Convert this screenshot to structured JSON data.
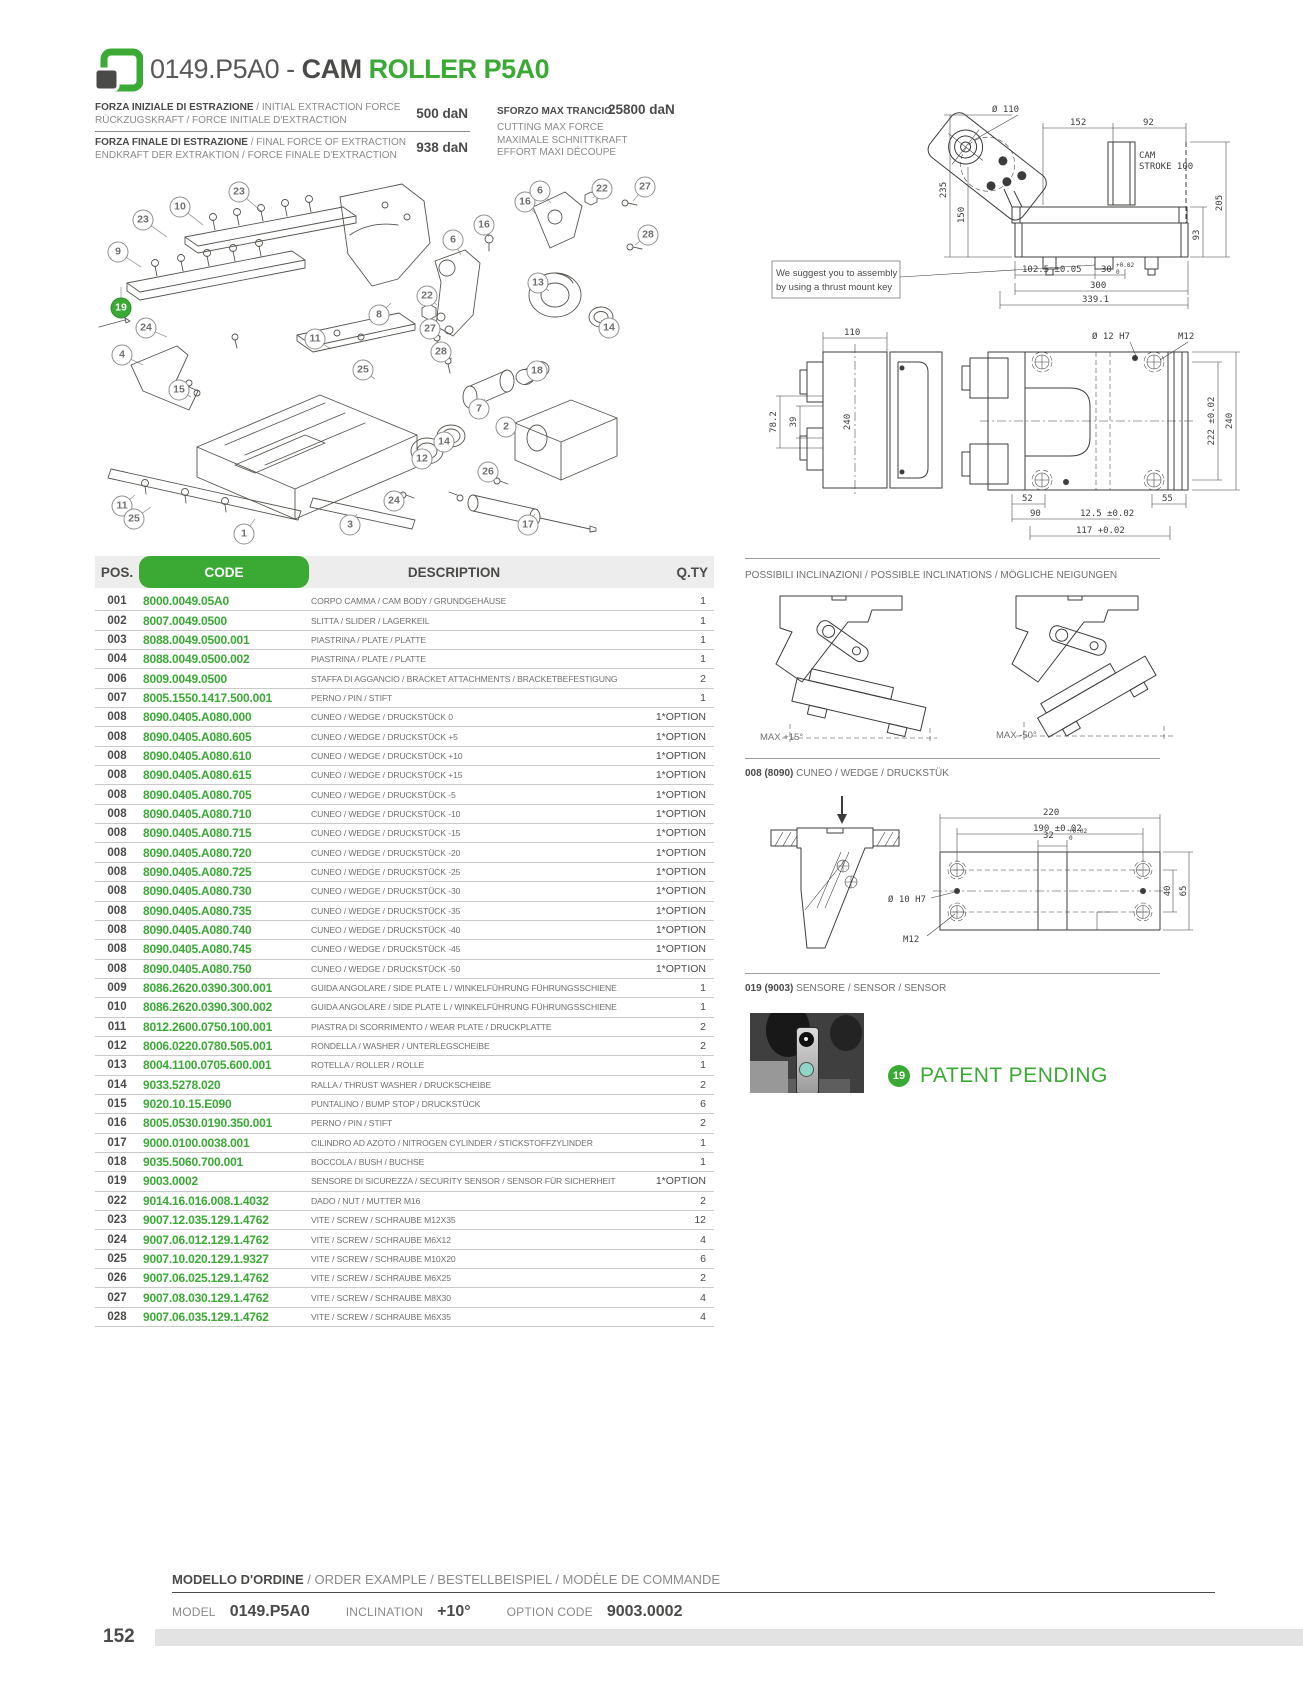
{
  "colors": {
    "green": "#3aaa35",
    "dark": "#4a4a49",
    "desc_gray": "#706f6f",
    "line_gray": "#c9c9c9",
    "header_bg": "#ededed",
    "teal": "#8fd6c6"
  },
  "header": {
    "code_text": "0149.P5A0 - ",
    "title_cam": "CAM ",
    "title_roller": "ROLLER P5A0",
    "logo_icon": "green-frame-logo"
  },
  "specs": {
    "initial": {
      "bold": "FORZA INIZIALE DI ESTRAZIONE",
      "rest": " / INITIAL EXTRACTION FORCE",
      "line2": "RÜCKZUGSKRAFT / FORCE INITIALE D'EXTRACTION",
      "value": "500 daN"
    },
    "final": {
      "bold": "FORZA FINALE DI ESTRAZIONE",
      "rest": " / FINAL FORCE OF EXTRACTION",
      "line2": "ENDKRAFT DER EXTRAKTION / FORCE FINALE D'EXTRACTION",
      "value": "938 daN"
    },
    "cutting": {
      "title": "SFORZO MAX TRANCIO",
      "value": "25800 daN",
      "l2": "CUTTING MAX FORCE",
      "l3": "MAXIMALE SCHNITTKRAFT",
      "l4": "EFFORT MAXI DÉCOUPE"
    }
  },
  "drawing1": {
    "note1": "We suggest you to assembly",
    "note2": "by using a thrust mount key",
    "dims": {
      "dia110": "Ø 110",
      "w152": "152",
      "w92": "92",
      "cam_l1": "CAM",
      "cam_l2": "STROKE 100",
      "h235": "235",
      "h150": "150",
      "h205": "205",
      "h93": "93",
      "w1025": "102.5 ±0.05",
      "w30": "30",
      "tol_up": "+0.02",
      "tol_dn": "0",
      "w300": "300",
      "w3391": "339.1"
    }
  },
  "drawing2": {
    "dims": {
      "w110": "110",
      "h782": "78.2",
      "h39": "39",
      "h240": "240",
      "dia12": "Ø 12 H7",
      "m12": "M12",
      "w52": "52",
      "w55": "55",
      "w90": "90",
      "w125": "12.5 ±0.02",
      "w117": "117 +0.02",
      "h222": "222 ±0.02",
      "h240r": "240"
    }
  },
  "table": {
    "headers": {
      "pos": "POS.",
      "code": "CODE",
      "desc": "DESCRIPTION",
      "qty": "Q.TY"
    },
    "rows": [
      [
        "001",
        "8000.0049.05A0",
        "CORPO CAMMA / CAM BODY / GRUNDGEHÄUSE",
        "1"
      ],
      [
        "002",
        "8007.0049.0500",
        "SLITTA / SLIDER / LAGERKEIL",
        "1"
      ],
      [
        "003",
        "8088.0049.0500.001",
        "PIASTRINA / PLATE / PLATTE",
        "1"
      ],
      [
        "004",
        "8088.0049.0500.002",
        "PIASTRINA / PLATE / PLATTE",
        "1"
      ],
      [
        "006",
        "8009.0049.0500",
        "STAFFA DI AGGANCIO / BRACKET ATTACHMENTS / BRACKETBEFESTIGUNG",
        "2"
      ],
      [
        "007",
        "8005.1550.1417.500.001",
        "PERNO / PIN / STIFT",
        "1"
      ],
      [
        "008",
        "8090.0405.A080.000",
        "CUNEO / WEDGE / DRUCKSTÜCK 0",
        "1*OPTION"
      ],
      [
        "008",
        "8090.0405.A080.605",
        "CUNEO / WEDGE / DRUCKSTÜCK +5",
        "1*OPTION"
      ],
      [
        "008",
        "8090.0405.A080.610",
        "CUNEO / WEDGE / DRUCKSTÜCK +10",
        "1*OPTION"
      ],
      [
        "008",
        "8090.0405.A080.615",
        "CUNEO / WEDGE / DRUCKSTÜCK +15",
        "1*OPTION"
      ],
      [
        "008",
        "8090.0405.A080.705",
        "CUNEO / WEDGE / DRUCKSTÜCK -5",
        "1*OPTION"
      ],
      [
        "008",
        "8090.0405.A080.710",
        "CUNEO / WEDGE / DRUCKSTÜCK -10",
        "1*OPTION"
      ],
      [
        "008",
        "8090.0405.A080.715",
        "CUNEO / WEDGE / DRUCKSTÜCK -15",
        "1*OPTION"
      ],
      [
        "008",
        "8090.0405.A080.720",
        "CUNEO / WEDGE / DRUCKSTÜCK -20",
        "1*OPTION"
      ],
      [
        "008",
        "8090.0405.A080.725",
        "CUNEO / WEDGE / DRUCKSTÜCK -25",
        "1*OPTION"
      ],
      [
        "008",
        "8090.0405.A080.730",
        "CUNEO / WEDGE / DRUCKSTÜCK -30",
        "1*OPTION"
      ],
      [
        "008",
        "8090.0405.A080.735",
        "CUNEO / WEDGE / DRUCKSTÜCK -35",
        "1*OPTION"
      ],
      [
        "008",
        "8090.0405.A080.740",
        "CUNEO / WEDGE / DRUCKSTÜCK -40",
        "1*OPTION"
      ],
      [
        "008",
        "8090.0405.A080.745",
        "CUNEO / WEDGE / DRUCKSTÜCK -45",
        "1*OPTION"
      ],
      [
        "008",
        "8090.0405.A080.750",
        "CUNEO / WEDGE / DRUCKSTÜCK -50",
        "1*OPTION"
      ],
      [
        "009",
        "8086.2620.0390.300.001",
        "GUIDA ANGOLARE / SIDE PLATE L / WINKELFÜHRUNG FÜHRUNGSSCHIENE",
        "1"
      ],
      [
        "010",
        "8086.2620.0390.300.002",
        "GUIDA ANGOLARE / SIDE PLATE L / WINKELFÜHRUNG FÜHRUNGSSCHIENE",
        "1"
      ],
      [
        "011",
        "8012.2600.0750.100.001",
        "PIASTRA DI SCORRIMENTO / WEAR PLATE / DRUCKPLATTE",
        "2"
      ],
      [
        "012",
        "8006.0220.0780.505.001",
        "RONDELLA / WASHER / UNTERLEGSCHEIBE",
        "2"
      ],
      [
        "013",
        "8004.1100.0705.600.001",
        "ROTELLA / ROLLER / ROLLE",
        "1"
      ],
      [
        "014",
        "9033.5278.020",
        "RALLA / THRUST WASHER / DRUCKSCHEIBE",
        "2"
      ],
      [
        "015",
        "9020.10.15.E090",
        "PUNTALINO / BUMP STOP / DRUCKSTÜCK",
        "6"
      ],
      [
        "016",
        "8005.0530.0190.350.001",
        "PERNO / PIN / STIFT",
        "2"
      ],
      [
        "017",
        "9000.0100.0038.001",
        "CILINDRO AD AZOTO / NITROGEN CYLINDER / STICKSTOFFZYLINDER",
        "1"
      ],
      [
        "018",
        "9035.5060.700.001",
        "BOCCOLA / BUSH / BUCHSE",
        "1"
      ],
      [
        "019",
        "9003.0002",
        "SENSORE DI SICUREZZA / SECURITY SENSOR / SENSOR FÜR SICHERHEIT",
        "1*OPTION"
      ],
      [
        "022",
        "9014.16.016.008.1.4032",
        "DADO / NUT / MUTTER M16",
        "2"
      ],
      [
        "023",
        "9007.12.035.129.1.4762",
        "VITE / SCREW / SCHRAUBE M12X35",
        "12"
      ],
      [
        "024",
        "9007.06.012.129.1.4762",
        "VITE / SCREW / SCHRAUBE M6X12",
        "4"
      ],
      [
        "025",
        "9007.10.020.129.1.9327",
        "VITE / SCREW / SCHRAUBE M10X20",
        "6"
      ],
      [
        "026",
        "9007.06.025.129.1.4762",
        "VITE / SCREW / SCHRAUBE M6X25",
        "2"
      ],
      [
        "027",
        "9007.08.030.129.1.4762",
        "VITE / SCREW / SCHRAUBE M8X30",
        "4"
      ],
      [
        "028",
        "9007.06.035.129.1.4762",
        "VITE / SCREW / SCHRAUBE M6X35",
        "4"
      ]
    ]
  },
  "inclinations": {
    "title": "POSSIBILI INCLINAZIONI / POSSIBLE INCLINATIONS / MÖGLICHE NEIGUNGEN",
    "left_label": "MAX +15°",
    "right_label": "MAX -50°"
  },
  "wedge": {
    "title_bold": "008 (8090)",
    "title_rest": " CUNEO / WEDGE / DRUCKSTÜK",
    "dims": {
      "w220": "220",
      "w190": "190 ±0.02",
      "w32": "32",
      "tol_up": "+0.02",
      "tol_dn": "0",
      "dia10": "Ø 10 H7",
      "m12": "M12",
      "h40": "40",
      "h65": "65"
    }
  },
  "sensor": {
    "title_bold": "019 (9003)",
    "title_rest": " SENSORE / SENSOR / SENSOR"
  },
  "patent": {
    "badge": "19",
    "label": "PATENT PENDING"
  },
  "order": {
    "title_bold": "MODELLO D'ORDINE",
    "title_rest": " / ORDER EXAMPLE / BESTELLBEISPIEL / MODÈLE DE COMMANDE",
    "model_label": "MODEL",
    "model_value": "0149.P5A0",
    "incl_label": "INCLINATION",
    "incl_value": "+10°",
    "opt_label": "OPTION CODE",
    "opt_value": "9003.0002"
  },
  "footer": {
    "page": "152"
  },
  "exploded": {
    "balloons": [
      {
        "n": "23",
        "x": 154,
        "y": 27,
        "lx": 176,
        "ly": 46
      },
      {
        "n": "10",
        "x": 95,
        "y": 42,
        "lx": 118,
        "ly": 60
      },
      {
        "n": "23",
        "x": 58,
        "y": 55,
        "lx": 82,
        "ly": 72
      },
      {
        "n": "9",
        "x": 33,
        "y": 87,
        "lx": 56,
        "ly": 102
      },
      {
        "n": "19",
        "x": 36,
        "y": 143,
        "g": true,
        "lx": 36,
        "ly": 122
      },
      {
        "n": "24",
        "x": 61,
        "y": 163,
        "lx": 82,
        "ly": 172
      },
      {
        "n": "4",
        "x": 37,
        "y": 190,
        "lx": 58,
        "ly": 200
      },
      {
        "n": "15",
        "x": 94,
        "y": 225,
        "lx": 106,
        "ly": 232
      },
      {
        "n": "11",
        "x": 230,
        "y": 174,
        "lx": 246,
        "ly": 184
      },
      {
        "n": "25",
        "x": 278,
        "y": 205,
        "lx": 290,
        "ly": 214
      },
      {
        "n": "8",
        "x": 294,
        "y": 150,
        "lx": 306,
        "ly": 138
      },
      {
        "n": "22",
        "x": 342,
        "y": 131,
        "lx": 352,
        "ly": 140
      },
      {
        "n": "6",
        "x": 368,
        "y": 75,
        "lx": 376,
        "ly": 90
      },
      {
        "n": "16",
        "x": 399,
        "y": 60,
        "lx": 404,
        "ly": 72
      },
      {
        "n": "27",
        "x": 345,
        "y": 164,
        "lx": 356,
        "ly": 172
      },
      {
        "n": "28",
        "x": 356,
        "y": 187,
        "lx": 367,
        "ly": 194
      },
      {
        "n": "16",
        "x": 440,
        "y": 37,
        "lx": 450,
        "ly": 48
      },
      {
        "n": "6",
        "x": 455,
        "y": 26,
        "lx": 466,
        "ly": 38
      },
      {
        "n": "22",
        "x": 517,
        "y": 24,
        "lx": 508,
        "ly": 33
      },
      {
        "n": "27",
        "x": 560,
        "y": 22,
        "lx": 548,
        "ly": 36
      },
      {
        "n": "28",
        "x": 563,
        "y": 70,
        "lx": 550,
        "ly": 80
      },
      {
        "n": "13",
        "x": 453,
        "y": 118,
        "lx": 464,
        "ly": 126
      },
      {
        "n": "14",
        "x": 524,
        "y": 163,
        "lx": 516,
        "ly": 155
      },
      {
        "n": "18",
        "x": 452,
        "y": 206,
        "lx": 447,
        "ly": 199
      },
      {
        "n": "7",
        "x": 394,
        "y": 244,
        "lx": 400,
        "ly": 234
      },
      {
        "n": "2",
        "x": 421,
        "y": 262,
        "lx": 432,
        "ly": 258
      },
      {
        "n": "14",
        "x": 359,
        "y": 277,
        "lx": 363,
        "ly": 270
      },
      {
        "n": "12",
        "x": 337,
        "y": 294,
        "lx": 341,
        "ly": 286
      },
      {
        "n": "26",
        "x": 403,
        "y": 307,
        "lx": 412,
        "ly": 314
      },
      {
        "n": "24",
        "x": 309,
        "y": 336,
        "lx": 318,
        "ly": 328
      },
      {
        "n": "11",
        "x": 37,
        "y": 341,
        "lx": 50,
        "ly": 330
      },
      {
        "n": "25",
        "x": 49,
        "y": 354,
        "lx": 66,
        "ly": 342
      },
      {
        "n": "1",
        "x": 159,
        "y": 369,
        "lx": 170,
        "ly": 354
      },
      {
        "n": "3",
        "x": 265,
        "y": 360,
        "lx": 272,
        "ly": 349
      },
      {
        "n": "17",
        "x": 443,
        "y": 360,
        "lx": 450,
        "ly": 349
      }
    ]
  }
}
